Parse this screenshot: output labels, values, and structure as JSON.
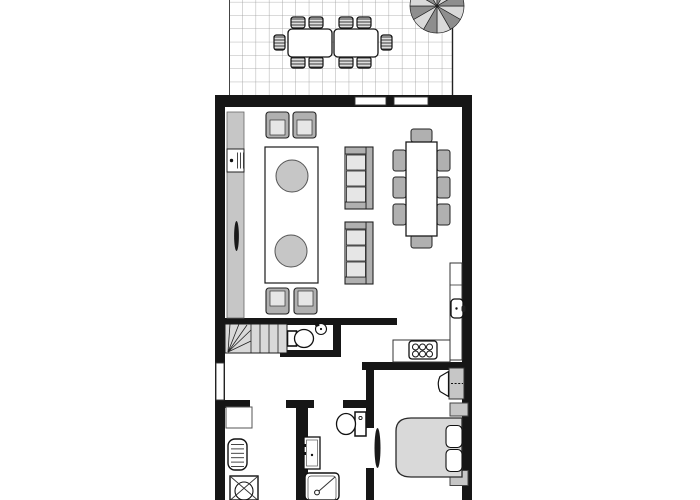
{
  "document": {
    "type": "architectural-floor-plan",
    "visible_text": [],
    "style": "black-white-gray line drawing, plan clipped at top and bottom edges"
  },
  "palette": {
    "wall": "#161616",
    "floor": "#ffffff",
    "furniture_gray": "#c6c6c6",
    "furniture_mid": "#b0b0b0",
    "light_gray": "#e6e6e6",
    "stair_gray": "#d9d9d9",
    "grid_line": "#9a9a9a",
    "parasol_light": "#d9d9d9",
    "parasol_dark": "#8e8e8e"
  },
  "rooms": [
    {
      "name": "terrace",
      "floor": "tiled-grid",
      "furniture": [
        "outdoor-dining-table x2 (pushed together)",
        "striped-chair x10",
        "parasol (12-segment, clipped at top)"
      ]
    },
    {
      "name": "living-dining-room",
      "furniture": [
        "sideboard-along-left-wall",
        "tv-unit",
        "door-handle-detail",
        "armchair x4",
        "rug",
        "round-coffee-table x2",
        "sofa x2 (3-seat, facing rug)",
        "dining-table",
        "dining-chair x8"
      ]
    },
    {
      "name": "kitchen",
      "furniture": [
        "l-shaped-counter",
        "sink-with-faucet",
        "cooktop-6-burner"
      ]
    },
    {
      "name": "staircase",
      "furniture": [
        "winder-stairs"
      ]
    },
    {
      "name": "wc",
      "furniture": [
        "toilet",
        "round-basin"
      ]
    },
    {
      "name": "hallway",
      "furniture": []
    },
    {
      "name": "utility-room",
      "furniture": [
        "cabinet",
        "radiator-boiler",
        "washing-machine (clipped)"
      ]
    },
    {
      "name": "bathroom",
      "furniture": [
        "vanity-sink",
        "toilet",
        "shower (clipped)"
      ]
    },
    {
      "name": "bedroom",
      "furniture": [
        "desk",
        "desk-chair",
        "double-bed",
        "pillow x2",
        "nightstand x2"
      ]
    }
  ],
  "openings": {
    "windows": [
      "top-wall-window-1",
      "top-wall-window-2",
      "hallway-left-window"
    ],
    "doors": [
      "bedroom-door-leaf",
      "utility-door-opening",
      "bathroom-door-opening"
    ]
  }
}
